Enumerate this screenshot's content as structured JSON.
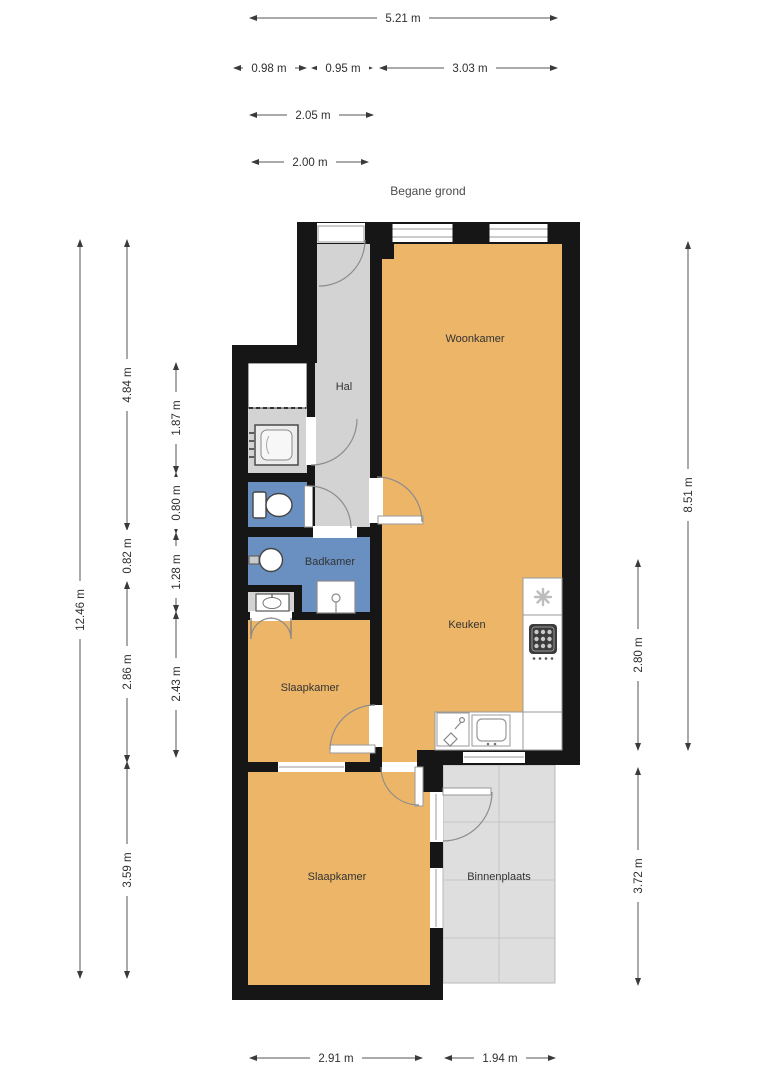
{
  "title": "Begane grond",
  "rooms": {
    "woonkamer": "Woonkamer",
    "hal": "Hal",
    "badkamer": "Badkamer",
    "keuken": "Keuken",
    "slaapkamer1": "Slaapkamer",
    "slaapkamer2": "Slaapkamer",
    "binnenplaats": "Binnenplaats"
  },
  "dims": {
    "w_total": "5.21 m",
    "w_a": "0.98 m",
    "w_b": "0.95 m",
    "w_c": "3.03 m",
    "w_d": "2.05 m",
    "w_e": "2.00 m",
    "h_total": "12.46 m",
    "h_a": "4.84 m",
    "h_b": "0.82 m",
    "h_c": "2.86 m",
    "h_d": "3.59 m",
    "i_a": "1.87 m",
    "i_b": "0.80 m",
    "i_c": "1.28 m",
    "i_d": "2.43 m",
    "r_a": "8.51 m",
    "r_b": "2.80 m",
    "r_c": "3.72 m",
    "b_a": "2.91 m",
    "b_b": "1.94 m"
  },
  "colors": {
    "wall": "#161616",
    "living_floor": "#ECB568",
    "wet_floor": "#6A90C2",
    "hall_floor": "#D3D3D3",
    "courtyard_floor": "#DEDEDE",
    "dimension_text": "#2F2F2F"
  }
}
